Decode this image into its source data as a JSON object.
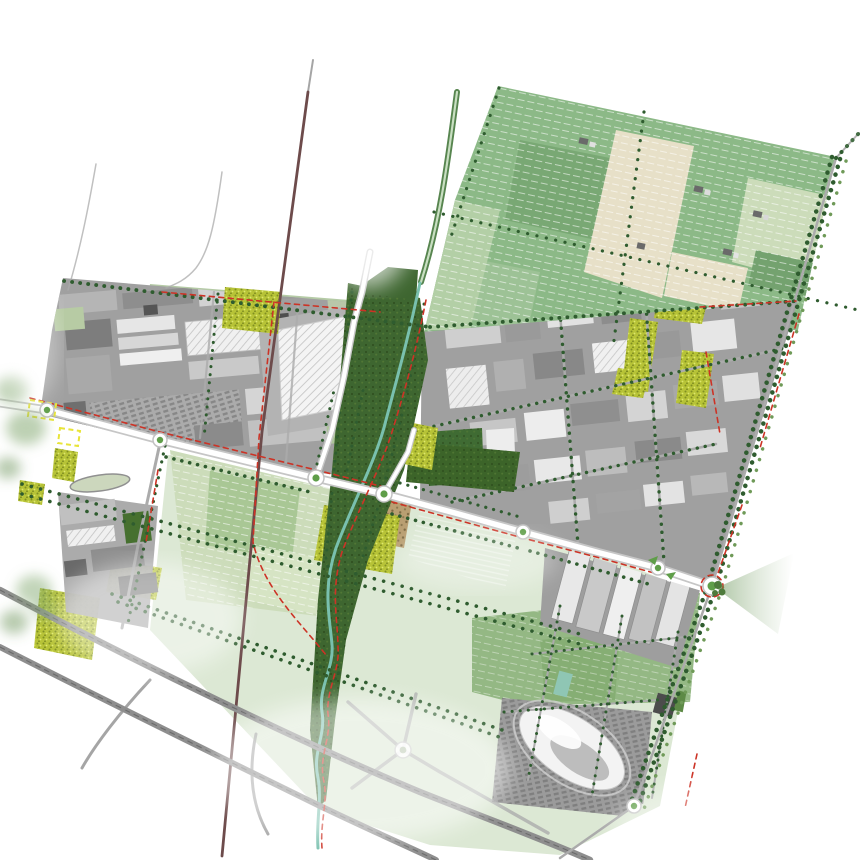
{
  "map": {
    "kind": "urban-landscape-masterplan-aerial-collage",
    "visible_text": "",
    "background": "#ffffff"
  },
  "palette": {
    "background": "#ffffff",
    "field_green": "#8cb987",
    "field_green_dark": "#79a874",
    "field_pale": "#ccdcba",
    "field_beige": "#e7e0c8",
    "field_faded": "#dce8d4",
    "lawn_green": "#94b884",
    "forest_green": "#3c6429",
    "corridor_green": "#3e6630",
    "scrub_chartreuse": "#b7c337",
    "tree_row": "#2f5c2f",
    "tree_row_light": "#6f9a58",
    "stream_teal": "#79c0ae",
    "road_white": "#ffffff",
    "road_casing": "#c6c6c6",
    "street_gray": "#ababab",
    "highway_gray": "#8e8e8e",
    "railway_maroon": "#6d4b4b",
    "cycle_red": "#cc3326",
    "outline_yellow": "#e8e437",
    "industrial_base": "#a0a0a0",
    "building_light": "#d9d9d9",
    "building_dark": "#7d7d7d",
    "roof_white": "#f2f2f2",
    "roundabout_green": "#5f9e49",
    "parking_gray": "#9b9b9b",
    "wash_white": "#ffffff"
  },
  "symbols": {
    "roundabout": "white-ring-with-green-center",
    "tree_row": "dark-green-dotted-line",
    "cycle_route": "red-dashed-line",
    "railway": "dark-maroon-line",
    "highway": "gray-carriageway-with-lane-dashes",
    "stream": "teal-winding-line",
    "canal": "green-double-line",
    "view_cone": "green-fading-wedge",
    "development_outline": "yellow-dashed-rectangle",
    "field_rows": "white-dotted-crop-stripes",
    "warehouse_roof": "diagonal-hatched-white-roof"
  }
}
